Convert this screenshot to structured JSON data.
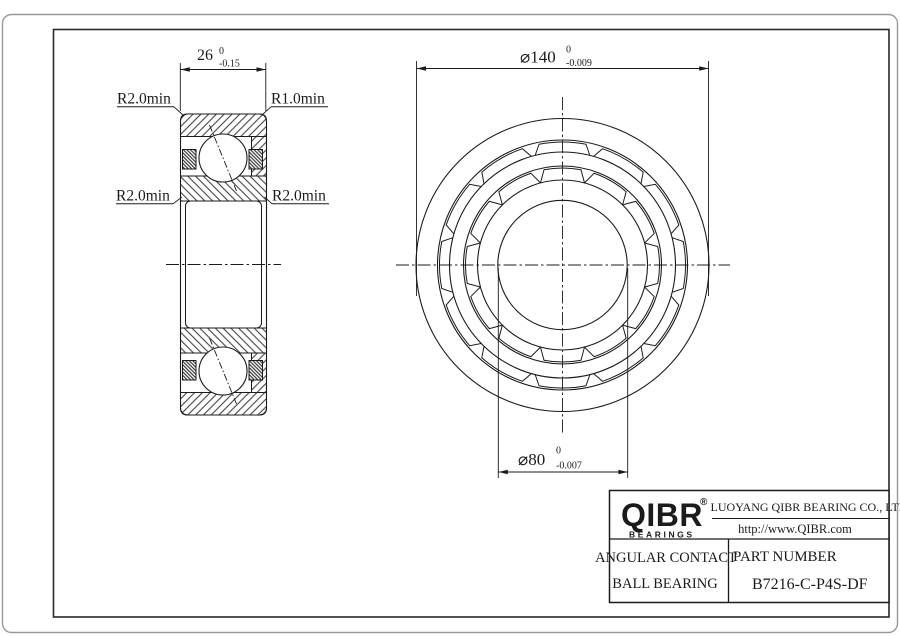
{
  "section_view": {
    "width_dim": {
      "value": "26",
      "tol_upper": "0",
      "tol_lower": "-0.15"
    },
    "labels": {
      "top_left": "R2.0min",
      "top_right": "R1.0min",
      "mid_left": "R2.0min",
      "mid_right": "R2.0min"
    }
  },
  "front_view": {
    "outer_dim": {
      "value": "⌀140",
      "tol_upper": "0",
      "tol_lower": "-0.009"
    },
    "bore_dim": {
      "value": "⌀80",
      "tol_upper": "0",
      "tol_lower": "-0.007"
    }
  },
  "title_block": {
    "logo": {
      "text": "QIBR",
      "registered": "®",
      "tagline": "BEARINGS"
    },
    "company": "LUOYANG QIBR BEARING CO., LTD",
    "website": "http://www.QIBR.com",
    "product_line1": "ANGULAR CONTACT",
    "product_line2": "BALL BEARING",
    "part_number_label": "PART NUMBER",
    "part_number": "B7216-C-P4S-DF"
  },
  "colors": {
    "line": "#1b1b1b",
    "frame": "#2a2a2a",
    "page_border": "#999999",
    "background": "#ffffff"
  }
}
